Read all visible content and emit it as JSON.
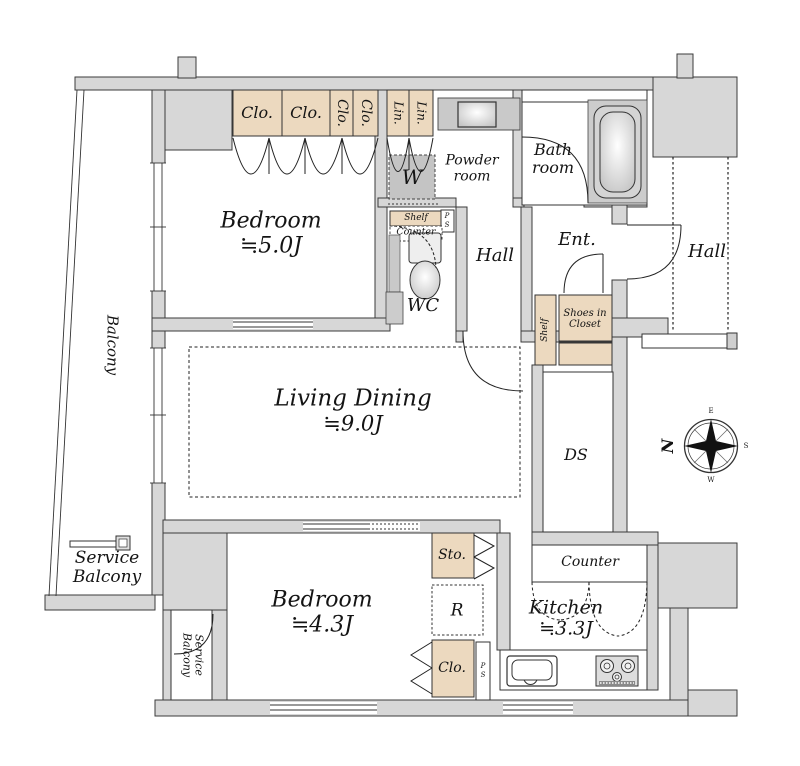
{
  "colors": {
    "wall": "#d7d7d7",
    "closet": "#ecd9bf",
    "fixture": "#c9c9c9",
    "line": "#333333",
    "background": "#ffffff"
  },
  "rooms": {
    "balcony": "Balcony",
    "bedroom1": {
      "name": "Bedroom",
      "size": "≒5.0J"
    },
    "living": {
      "name": "Living Dining",
      "size": "≒9.0J"
    },
    "bedroom2": {
      "name": "Bedroom",
      "size": "≒4.3J"
    },
    "kitchen": {
      "name": "Kitchen",
      "size": "≒3.3J"
    },
    "bath": {
      "line1": "Bath",
      "line2": "room"
    },
    "powder": {
      "line1": "Powder",
      "line2": "room"
    },
    "wc": "WC",
    "hall_inner": "Hall",
    "hall_outer": "Hall",
    "entrance": "Ent.",
    "ds": "DS",
    "service_balcony": {
      "line1": "Service",
      "line2": "Balcony"
    },
    "service_balcony_small": {
      "line1": "Service",
      "line2": "Balcony"
    }
  },
  "storage": {
    "clo": "Clo.",
    "lin": "Lin.",
    "washer": "W",
    "shelf": "Shelf",
    "counter": "Counter",
    "kitchen_counter": "Counter",
    "shoes_closet": {
      "line1": "Shoes in",
      "line2": "Closet"
    },
    "sto": "Sto.",
    "fridge": "R",
    "ps_p": "P",
    "ps_s": "S"
  },
  "compass": {
    "n": "N",
    "e": "E",
    "s": "S",
    "w": "W"
  }
}
